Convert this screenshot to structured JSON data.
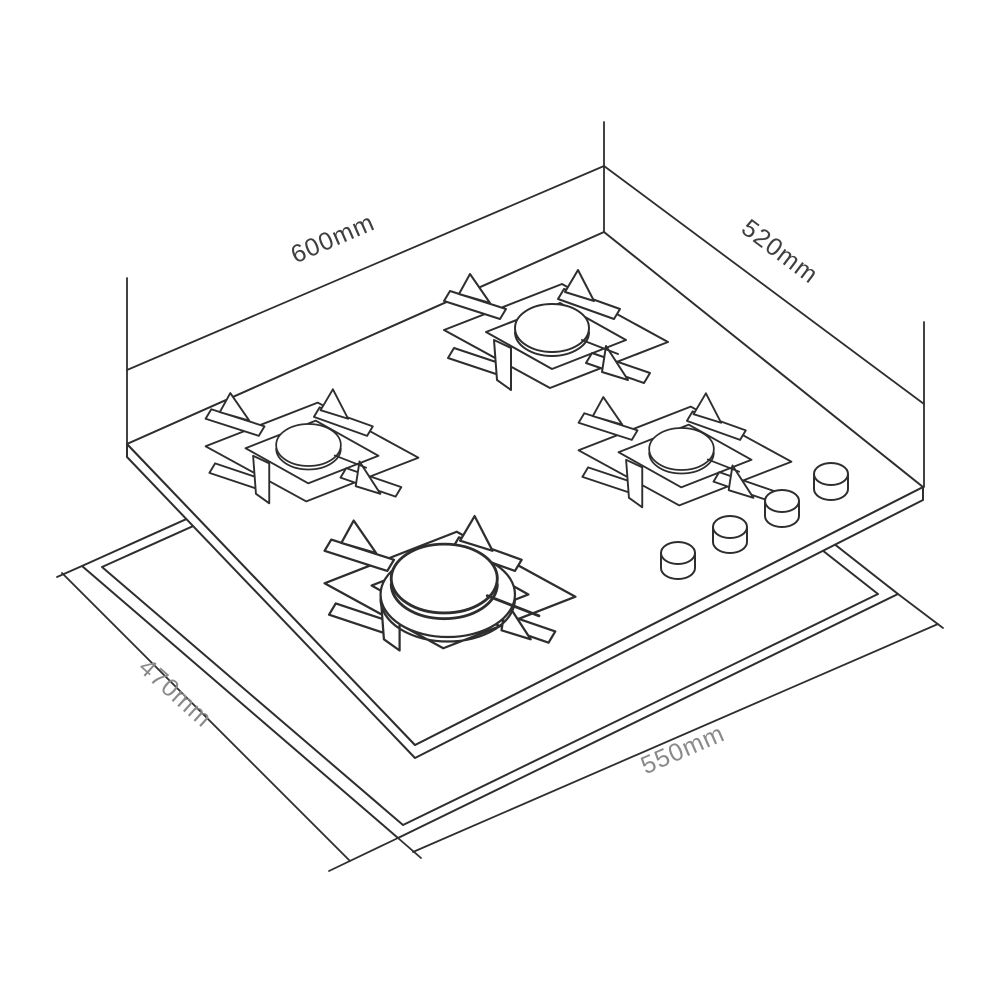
{
  "diagram": {
    "dimensions": {
      "top_width": "600mm",
      "right_depth": "520mm",
      "cutout_left_depth": "470mm",
      "cutout_bottom_width": "550mm"
    },
    "parts": {
      "burners": 4,
      "control_knobs": 4
    },
    "colors": {
      "line": "#2e2e2e",
      "label_dark": "#3f3f3f",
      "label_light": "#8a8a8a",
      "background": "#ffffff"
    }
  }
}
